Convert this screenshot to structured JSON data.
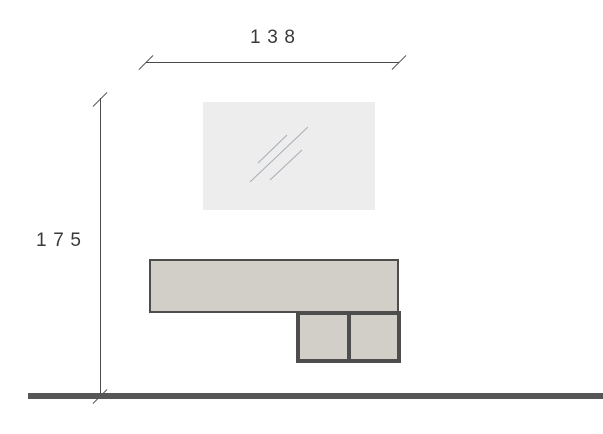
{
  "dimensions": {
    "width_label": "138",
    "height_label": "175"
  },
  "elements": {
    "mirror": "mirror panel with reflection hatch",
    "console": "wall console shelf",
    "drawers": "two drawer boxes",
    "floor": "floor line"
  },
  "colors": {
    "cabinet_fill": "#d2cec8",
    "outline": "#4d4d4d",
    "mirror_fill": "#ededee",
    "mirror_hatch": "#a6adb5",
    "dimension_line": "#4a4a4a",
    "floor": "#565656",
    "label_text": "#3a3a3a"
  }
}
